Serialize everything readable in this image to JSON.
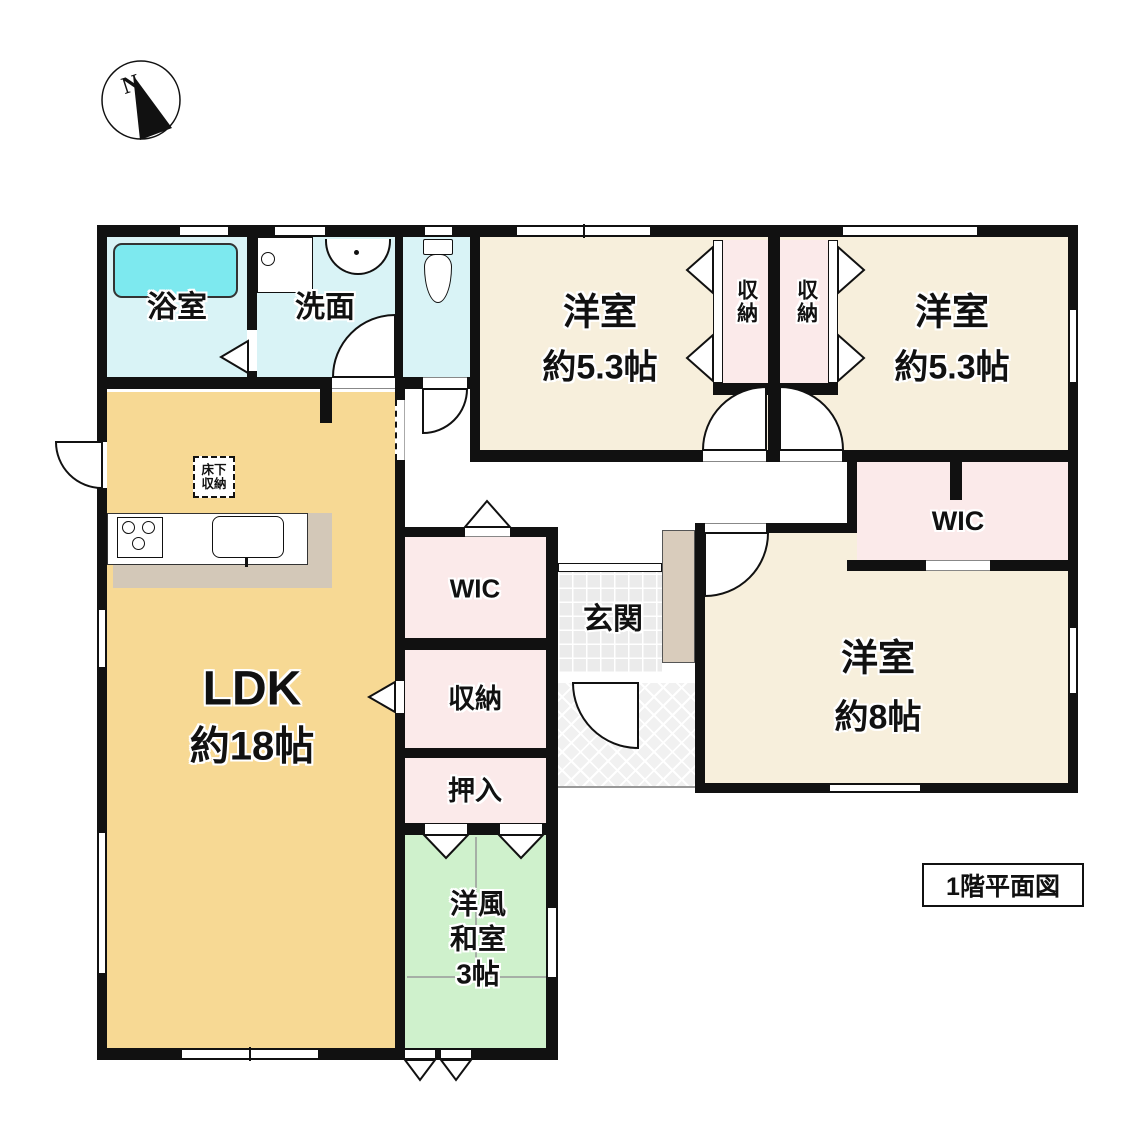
{
  "plan": {
    "title": "1階平面図",
    "compass_n": "N"
  },
  "rooms": {
    "bathroom": {
      "label": "浴室"
    },
    "washroom": {
      "label": "洗面"
    },
    "western_room_1": {
      "label": "洋室",
      "size": "約5.3帖"
    },
    "western_room_2": {
      "label": "洋室",
      "size": "約5.3帖"
    },
    "western_room_3": {
      "label": "洋室",
      "size": "約8帖"
    },
    "closet_top_1": {
      "label": "収納"
    },
    "closet_top_2": {
      "label": "収納"
    },
    "wic_right": {
      "label": "WIC"
    },
    "wic_center": {
      "label": "WIC"
    },
    "storage_center": {
      "label": "収納"
    },
    "oshiire": {
      "label": "押入"
    },
    "japanese_room": {
      "line1": "洋風",
      "line2": "和室",
      "line3": "3帖"
    },
    "ldk": {
      "label": "LDK",
      "size": "約18帖"
    },
    "entrance": {
      "label": "玄関"
    },
    "underfloor_storage": {
      "line1": "床下",
      "line2": "収納"
    }
  },
  "colors": {
    "wall": "#111111",
    "western_room": "#f7efdc",
    "ldk": "#f7d994",
    "wet_area": "#d9f3f6",
    "bathtub": "#7de9ef",
    "closet": "#fbeaea",
    "tatami_room": "#cff1cc",
    "kitchen_counter": "#d3c8b8",
    "shoe_cabinet": "#d9ccbc"
  }
}
